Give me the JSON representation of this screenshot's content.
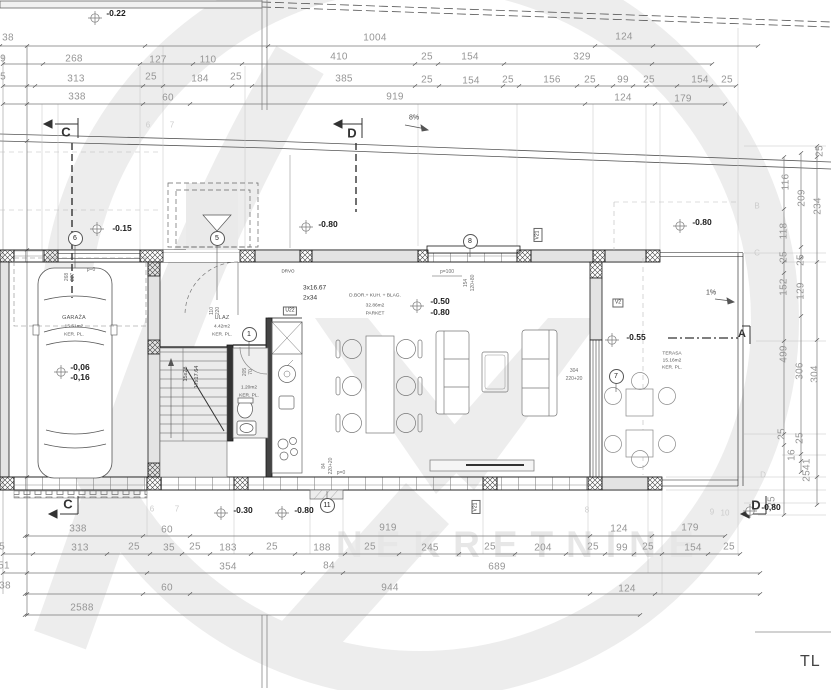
{
  "watermark": {
    "brand": "NEKRETNINE"
  },
  "annotations": {
    "road_slope": "8%",
    "terrace_slope": "1%",
    "sheet_label": "TL"
  },
  "sections": {
    "c_top": "C",
    "d_top": "D",
    "a": "A",
    "c_bottom": "C",
    "d_bottom": "D"
  },
  "elevations": {
    "top_street": "-0.22",
    "driveway": "-0.15",
    "plateau_left": "-0.80",
    "plateau_right": "-0.80",
    "living_a": "-0.50",
    "living_b": "-0.80",
    "garage_a": "-0,06",
    "garage_b": "-0,16",
    "terrace": "-0.55",
    "bottom_a": "-0.30",
    "bottom_b": "-0.80",
    "bottom_right": "-0,80"
  },
  "rooms": {
    "garage": {
      "name": "GARAŽA",
      "area": "15.51m2",
      "floor": "KER. PL."
    },
    "entry": {
      "name": "ULAZ",
      "area": "4.42m2",
      "floor": "KER. PL."
    },
    "living": {
      "name": "D.BOR.+ KUH. + BLAG.",
      "area": "32.86m2",
      "floor": "PARKET"
    },
    "wc": {
      "area": "1.20m2",
      "floor": "KER. PL."
    },
    "terrace": {
      "name": "TERASA",
      "area": "15.16m2",
      "floor": "KER. PL."
    }
  },
  "stairs": {
    "flight": "15x28",
    "risers": "17x17.64",
    "steps_note_1": "3x16.67",
    "steps_note_2": "2x34",
    "material": "DRVO"
  },
  "opening_labels": {
    "u22": "U22",
    "v2": "V2",
    "v21_top": "V21",
    "v21_bottom": "V21",
    "p0_garage": "p=0",
    "p100": "p=100",
    "slider_w": "304",
    "slider_h": "220+20"
  },
  "bubbles": {
    "b1": "1",
    "b5": "5",
    "b6": "6",
    "b7": "7",
    "b8": "8",
    "b11": "11"
  },
  "grid_labels": [
    {
      "t": "6",
      "x": 148,
      "y": 125
    },
    {
      "t": "7",
      "x": 172,
      "y": 125
    },
    {
      "t": "6",
      "x": 152,
      "y": 509
    },
    {
      "t": "7",
      "x": 177,
      "y": 509
    },
    {
      "t": "8",
      "x": 587,
      "y": 510
    },
    {
      "t": "9",
      "x": 712,
      "y": 512
    },
    {
      "t": "10",
      "x": 725,
      "y": 513
    },
    {
      "t": "B",
      "x": 757,
      "y": 206
    },
    {
      "t": "C",
      "x": 757,
      "y": 253
    },
    {
      "t": "D",
      "x": 763,
      "y": 475
    }
  ],
  "dim_labels": [
    {
      "t": "38",
      "x": 8,
      "y": 38
    },
    {
      "t": "1004",
      "x": 375,
      "y": 38
    },
    {
      "t": "124",
      "x": 624,
      "y": 37
    },
    {
      "t": "9",
      "x": 3,
      "y": 59
    },
    {
      "t": "268",
      "x": 74,
      "y": 59
    },
    {
      "t": "127",
      "x": 158,
      "y": 60
    },
    {
      "t": "110",
      "x": 208,
      "y": 60
    },
    {
      "t": "410",
      "x": 339,
      "y": 57
    },
    {
      "t": "25",
      "x": 427,
      "y": 57
    },
    {
      "t": "154",
      "x": 470,
      "y": 57
    },
    {
      "t": "329",
      "x": 582,
      "y": 57
    },
    {
      "t": "5",
      "x": 3,
      "y": 77
    },
    {
      "t": "313",
      "x": 76,
      "y": 79
    },
    {
      "t": "25",
      "x": 151,
      "y": 77
    },
    {
      "t": "184",
      "x": 200,
      "y": 79
    },
    {
      "t": "25",
      "x": 236,
      "y": 77
    },
    {
      "t": "385",
      "x": 344,
      "y": 79
    },
    {
      "t": "25",
      "x": 427,
      "y": 80
    },
    {
      "t": "154",
      "x": 471,
      "y": 81
    },
    {
      "t": "25",
      "x": 508,
      "y": 80
    },
    {
      "t": "156",
      "x": 552,
      "y": 80
    },
    {
      "t": "25",
      "x": 590,
      "y": 80
    },
    {
      "t": "99",
      "x": 623,
      "y": 80
    },
    {
      "t": "25",
      "x": 649,
      "y": 80
    },
    {
      "t": "154",
      "x": 700,
      "y": 80
    },
    {
      "t": "25",
      "x": 727,
      "y": 80
    },
    {
      "t": "338",
      "x": 77,
      "y": 97
    },
    {
      "t": "60",
      "x": 168,
      "y": 98
    },
    {
      "t": "919",
      "x": 395,
      "y": 97
    },
    {
      "t": "124",
      "x": 623,
      "y": 98
    },
    {
      "t": "179",
      "x": 683,
      "y": 99
    },
    {
      "t": "338",
      "x": 78,
      "y": 529
    },
    {
      "t": "60",
      "x": 167,
      "y": 530
    },
    {
      "t": "919",
      "x": 388,
      "y": 528
    },
    {
      "t": "124",
      "x": 619,
      "y": 529
    },
    {
      "t": "179",
      "x": 690,
      "y": 528
    },
    {
      "t": "5",
      "x": 2,
      "y": 547
    },
    {
      "t": "313",
      "x": 80,
      "y": 548
    },
    {
      "t": "25",
      "x": 134,
      "y": 547
    },
    {
      "t": "35",
      "x": 169,
      "y": 548
    },
    {
      "t": "25",
      "x": 195,
      "y": 547
    },
    {
      "t": "183",
      "x": 228,
      "y": 548
    },
    {
      "t": "25",
      "x": 272,
      "y": 547
    },
    {
      "t": "188",
      "x": 322,
      "y": 548
    },
    {
      "t": "25",
      "x": 370,
      "y": 547
    },
    {
      "t": "245",
      "x": 430,
      "y": 548
    },
    {
      "t": "25",
      "x": 490,
      "y": 547
    },
    {
      "t": "204",
      "x": 543,
      "y": 548
    },
    {
      "t": "25",
      "x": 593,
      "y": 547
    },
    {
      "t": "99",
      "x": 622,
      "y": 548
    },
    {
      "t": "25",
      "x": 648,
      "y": 547
    },
    {
      "t": "154",
      "x": 693,
      "y": 548
    },
    {
      "t": "25",
      "x": 729,
      "y": 547
    },
    {
      "t": "51",
      "x": 4,
      "y": 566
    },
    {
      "t": "354",
      "x": 228,
      "y": 567
    },
    {
      "t": "84",
      "x": 329,
      "y": 566
    },
    {
      "t": "689",
      "x": 497,
      "y": 567
    },
    {
      "t": "38",
      "x": 5,
      "y": 586
    },
    {
      "t": "60",
      "x": 167,
      "y": 588
    },
    {
      "t": "944",
      "x": 390,
      "y": 588
    },
    {
      "t": "124",
      "x": 627,
      "y": 589
    },
    {
      "t": "2588",
      "x": 82,
      "y": 608
    },
    {
      "t": "25",
      "x": 820,
      "y": 151,
      "r": 1
    },
    {
      "t": "116",
      "x": 786,
      "y": 182,
      "r": 1
    },
    {
      "t": "209",
      "x": 802,
      "y": 198,
      "r": 1
    },
    {
      "t": "234",
      "x": 818,
      "y": 206,
      "r": 1
    },
    {
      "t": "118",
      "x": 784,
      "y": 231,
      "r": 1
    },
    {
      "t": "25",
      "x": 784,
      "y": 257,
      "r": 1
    },
    {
      "t": "25",
      "x": 801,
      "y": 260,
      "r": 1
    },
    {
      "t": "152",
      "x": 784,
      "y": 287,
      "r": 1
    },
    {
      "t": "129",
      "x": 801,
      "y": 291,
      "r": 1
    },
    {
      "t": "499",
      "x": 784,
      "y": 354,
      "r": 1
    },
    {
      "t": "306",
      "x": 800,
      "y": 371,
      "r": 1
    },
    {
      "t": "304",
      "x": 815,
      "y": 374,
      "r": 1
    },
    {
      "t": "25",
      "x": 782,
      "y": 434,
      "r": 1
    },
    {
      "t": "25",
      "x": 800,
      "y": 438,
      "r": 1
    },
    {
      "t": "16",
      "x": 792,
      "y": 455,
      "r": 1
    },
    {
      "t": "2541",
      "x": 807,
      "y": 470,
      "r": 1
    },
    {
      "t": "25",
      "x": 772,
      "y": 502,
      "r": 1
    },
    {
      "t": "268",
      "x": 67,
      "y": 277,
      "r": 1,
      "s": 1
    },
    {
      "t": "227",
      "x": 73,
      "y": 277,
      "r": 1,
      "s": 1
    },
    {
      "t": "p=0",
      "x": 91,
      "y": 270,
      "s": 1
    },
    {
      "t": "110",
      "x": 212,
      "y": 311,
      "r": 1,
      "s": 1
    },
    {
      "t": "220",
      "x": 218,
      "y": 311,
      "r": 1,
      "s": 1
    },
    {
      "t": "205",
      "x": 245,
      "y": 372,
      "r": 1,
      "s": 1
    },
    {
      "t": "70",
      "x": 251,
      "y": 372,
      "r": 1,
      "s": 1
    },
    {
      "t": "154",
      "x": 466,
      "y": 283,
      "r": 1,
      "s": 1
    },
    {
      "t": "120+80",
      "x": 473,
      "y": 283,
      "r": 1,
      "s": 1
    },
    {
      "t": "p=100",
      "x": 447,
      "y": 272,
      "s": 1
    },
    {
      "t": "84",
      "x": 324,
      "y": 466,
      "r": 1,
      "s": 1
    },
    {
      "t": "220+20",
      "x": 331,
      "y": 466,
      "r": 1,
      "s": 1
    },
    {
      "t": "p=0",
      "x": 341,
      "y": 473,
      "s": 1
    }
  ]
}
